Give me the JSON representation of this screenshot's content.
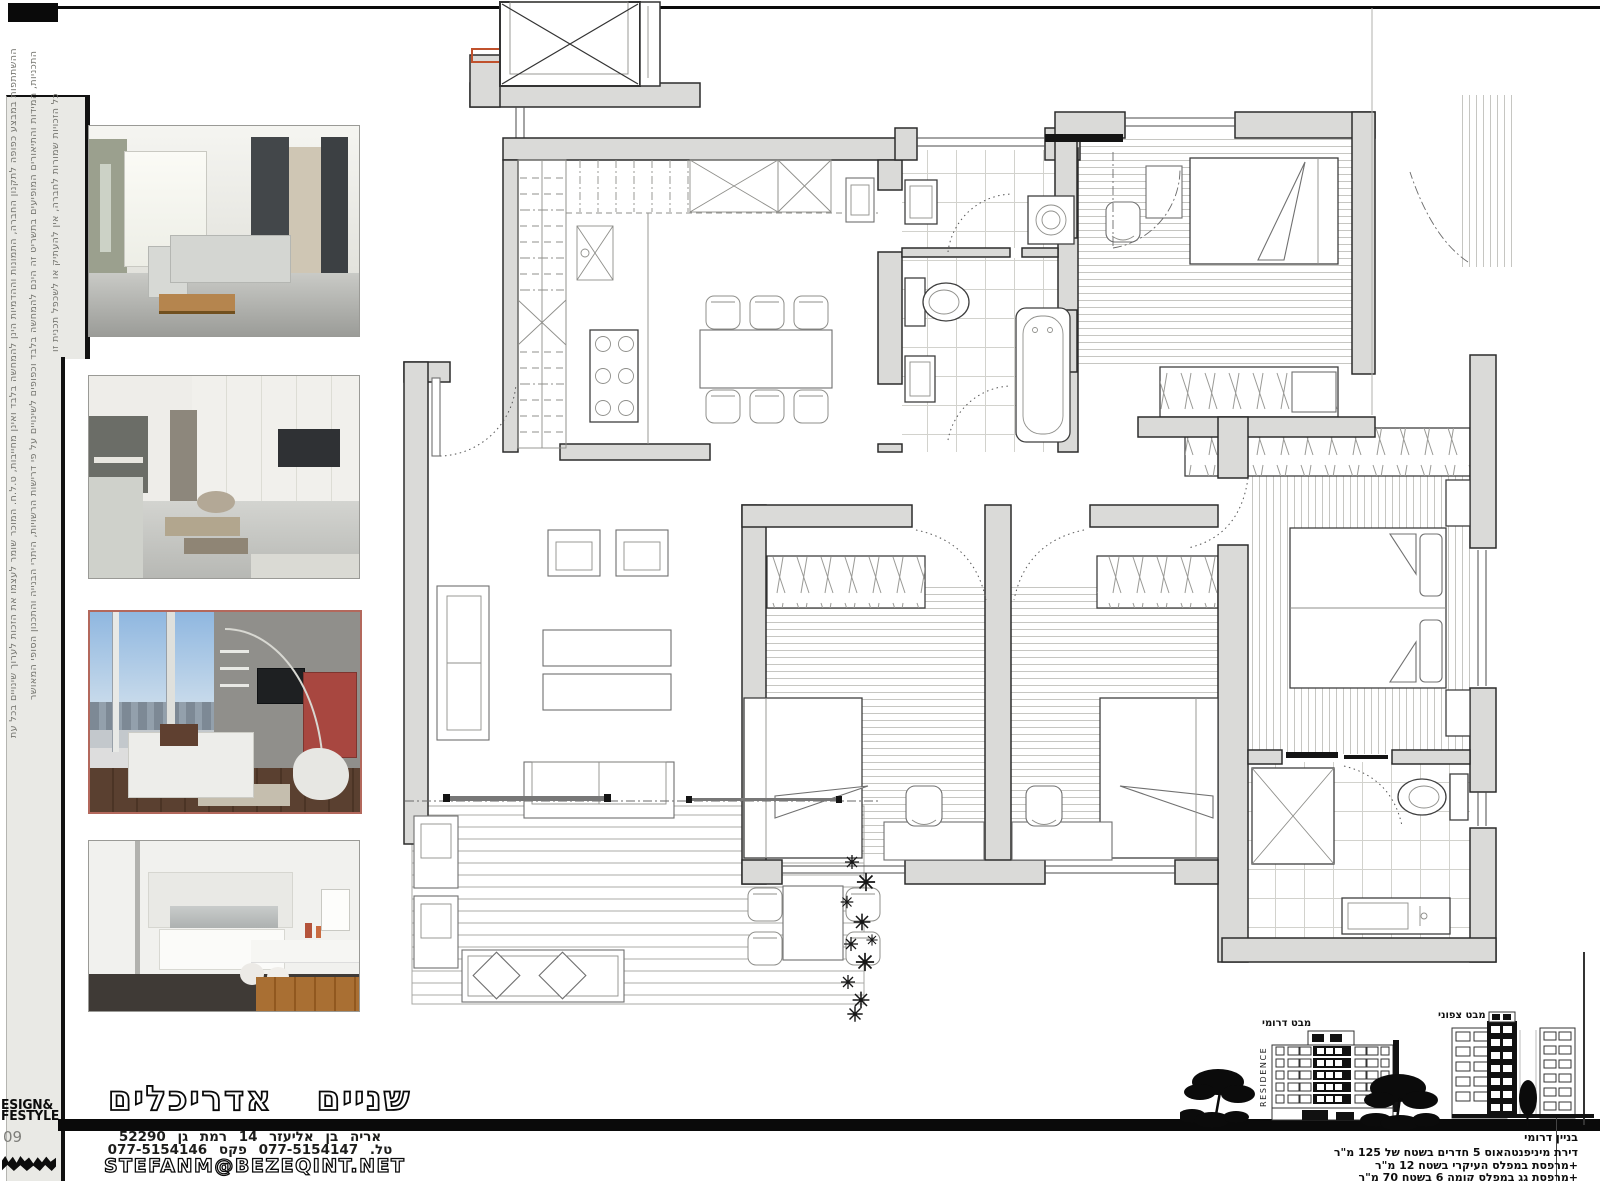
{
  "sidebar": {
    "disclaimer_line1": "כל הזכויות שמורות לחברה, אין להעתיק או לשכפל תכנית זו",
    "disclaimer_line2": "התכניות, המידות והתיאורים המופיעים בתשריט זה הינם להמחשה בלבד וכפופים לשינויים על פי דרישות הרשויות, היתרי הבנייה והתכנון הסופי המאושר",
    "disclaimer_line3": "ההשתתפות במבצע כפופה לתקנון החברה, התמונות וההדמיות הינן להמחשה בלבד ואינן מחייבות, ט.ל.ח. המוכר שומר לעצמו את הזכות לערוך שינויים בכל עת"
  },
  "masthead": {
    "brand_line1": "ESIGN&",
    "brand_line2": "FESTYLE",
    "issue_number": "09"
  },
  "studio": {
    "name": "שניים אדריכלים",
    "address": "אריה בן אליעזר 14 רמת גן 52290",
    "phone_fax": "טל. 077-5154147 פקס 077-5154146",
    "email": "STEFANM@BEZEQINT.NET"
  },
  "elevations": {
    "south_label": "מבט דרומי",
    "north_label": "מבט צפוני",
    "residence_text": "RESIDENCE"
  },
  "apartment_notes": {
    "building": "בניין דרומי",
    "line1": "דירת מיניפנטהאוס 5 חדרים בשטח של 125 מ\"ר",
    "line2": "+מרפסת במפלס העיקרי בשטח 12 מ\"ר",
    "line3": "+מרפסת גג במפלס קומה 6 בשטח 70 מ\"ר"
  }
}
